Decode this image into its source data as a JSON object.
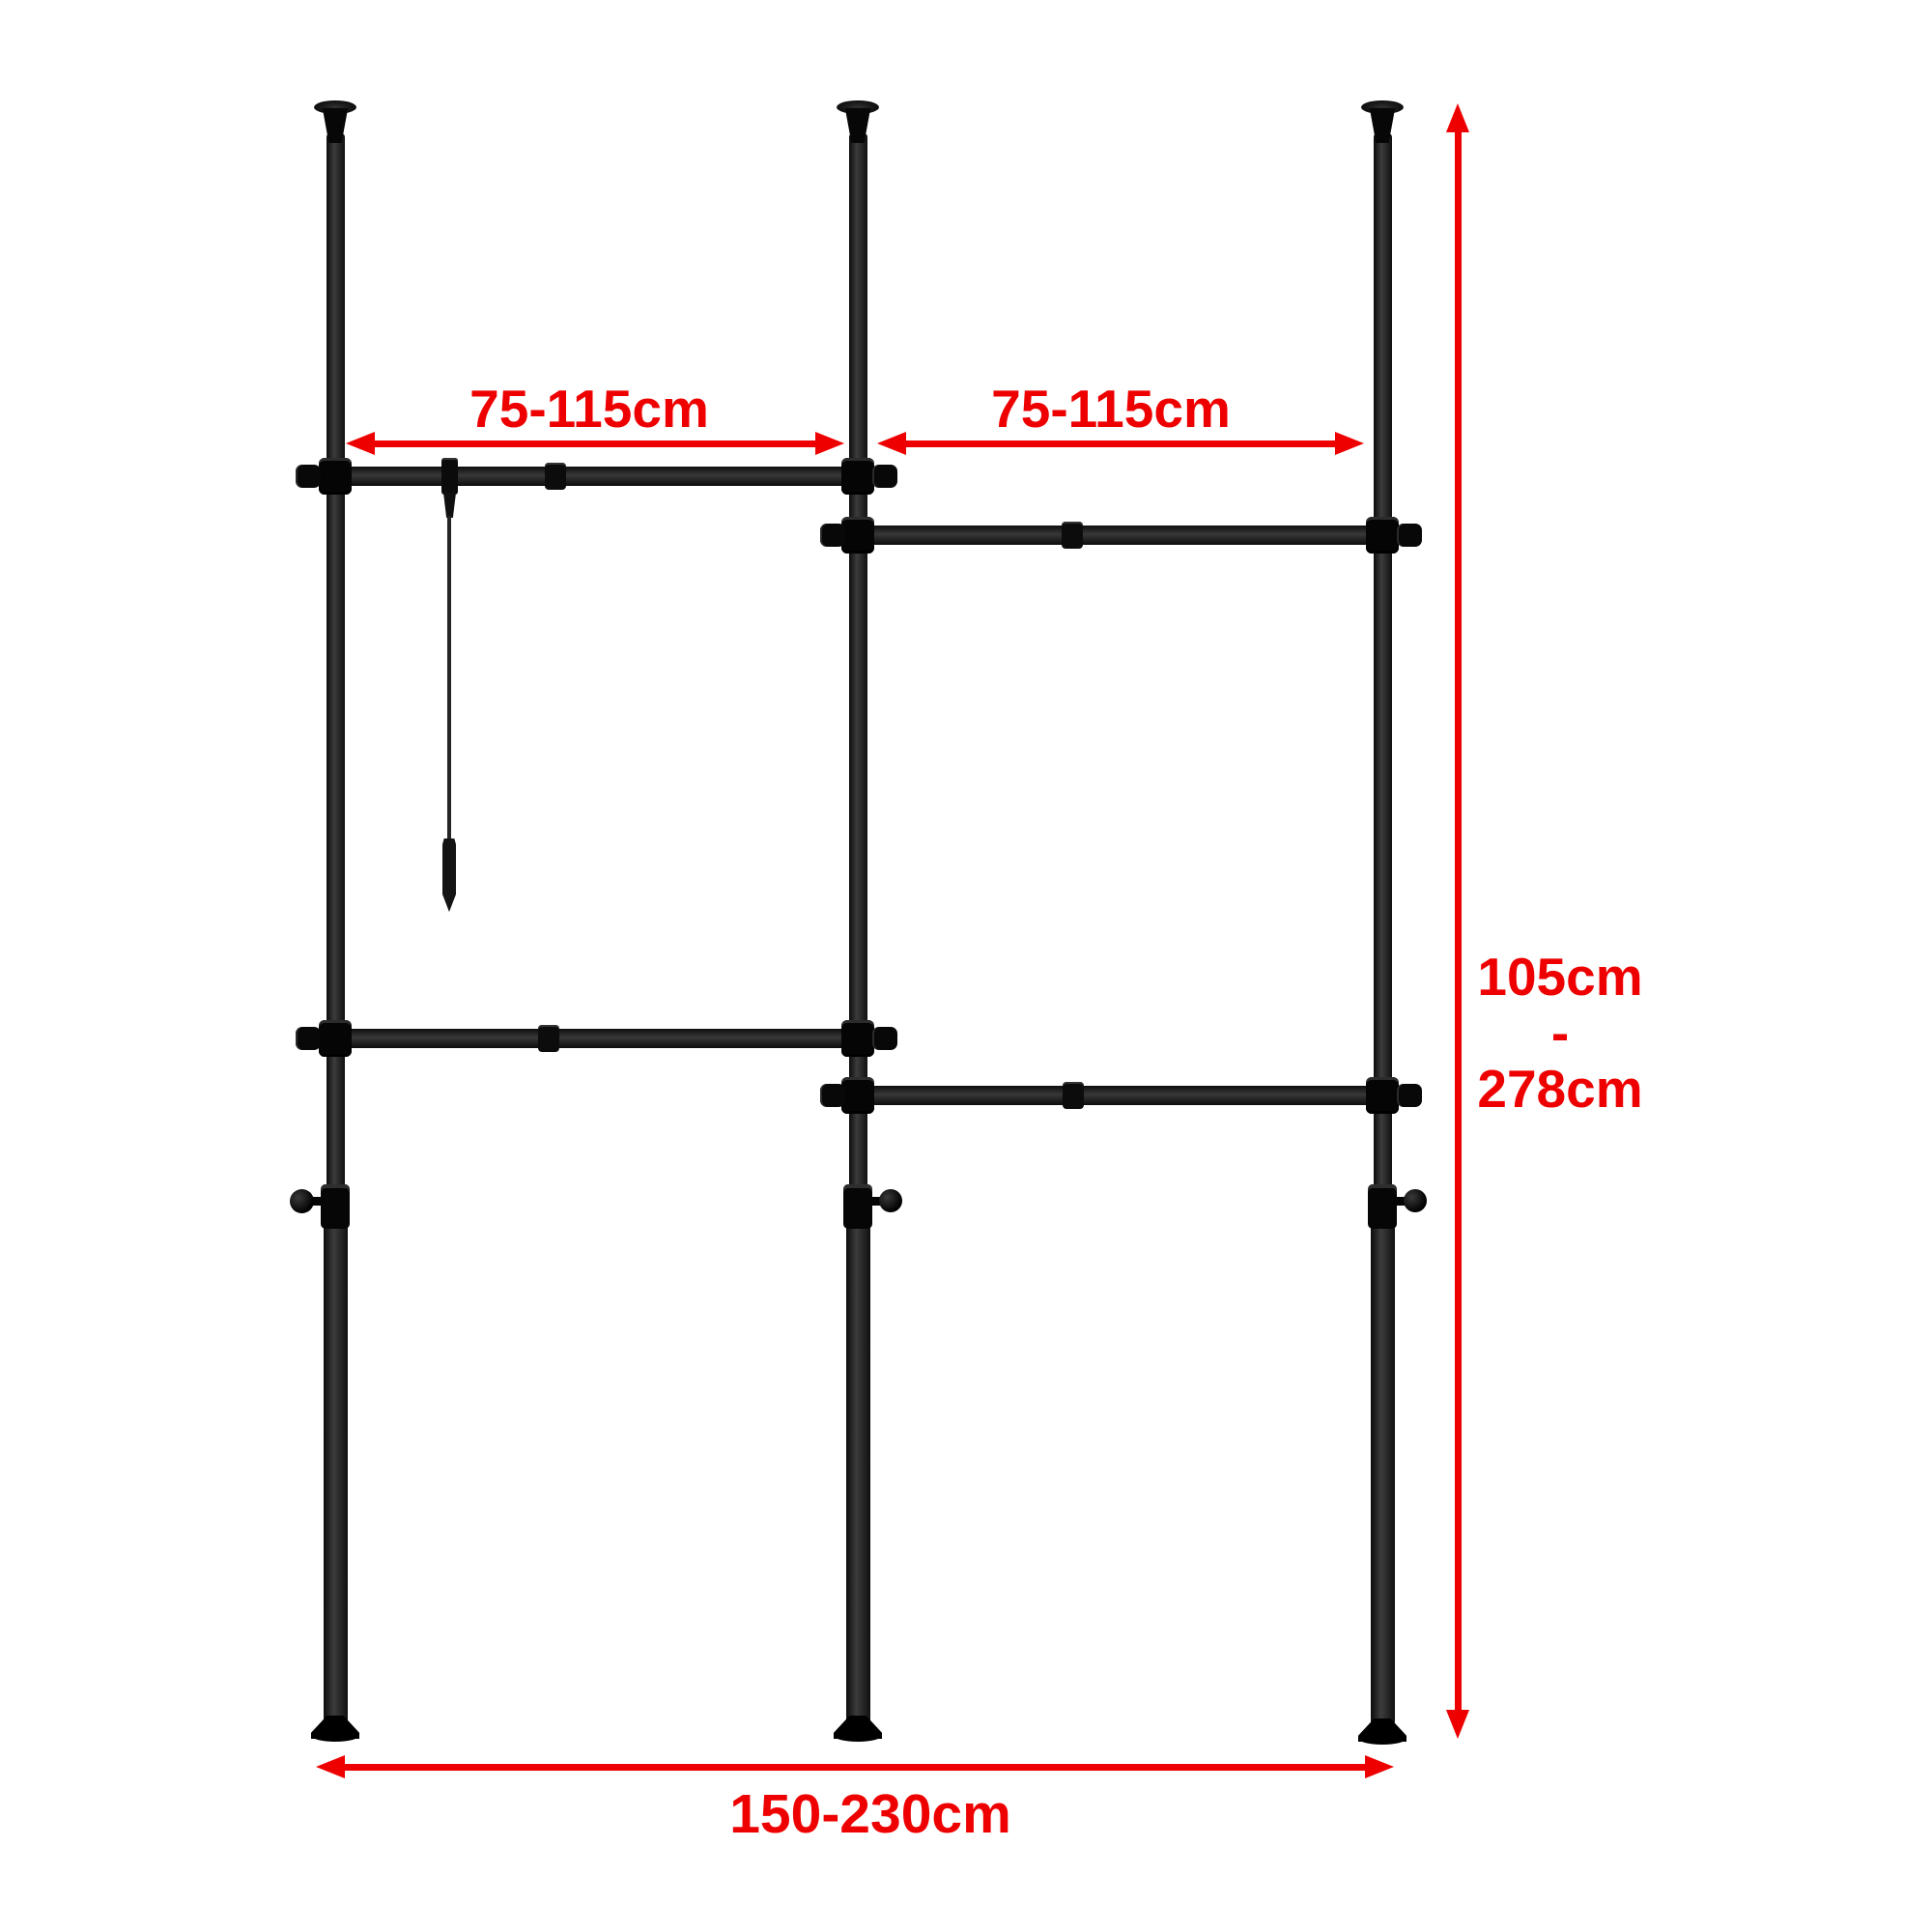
{
  "diagram": {
    "background_color": "#ffffff",
    "accent_color": "#ee0000",
    "frame_color": "#161616",
    "labels": {
      "left_span": "75-115cm",
      "right_span": "75-115cm",
      "height_min": "105cm",
      "height_separator": "-",
      "height_max": "278cm",
      "total_width": "150-230cm"
    }
  }
}
